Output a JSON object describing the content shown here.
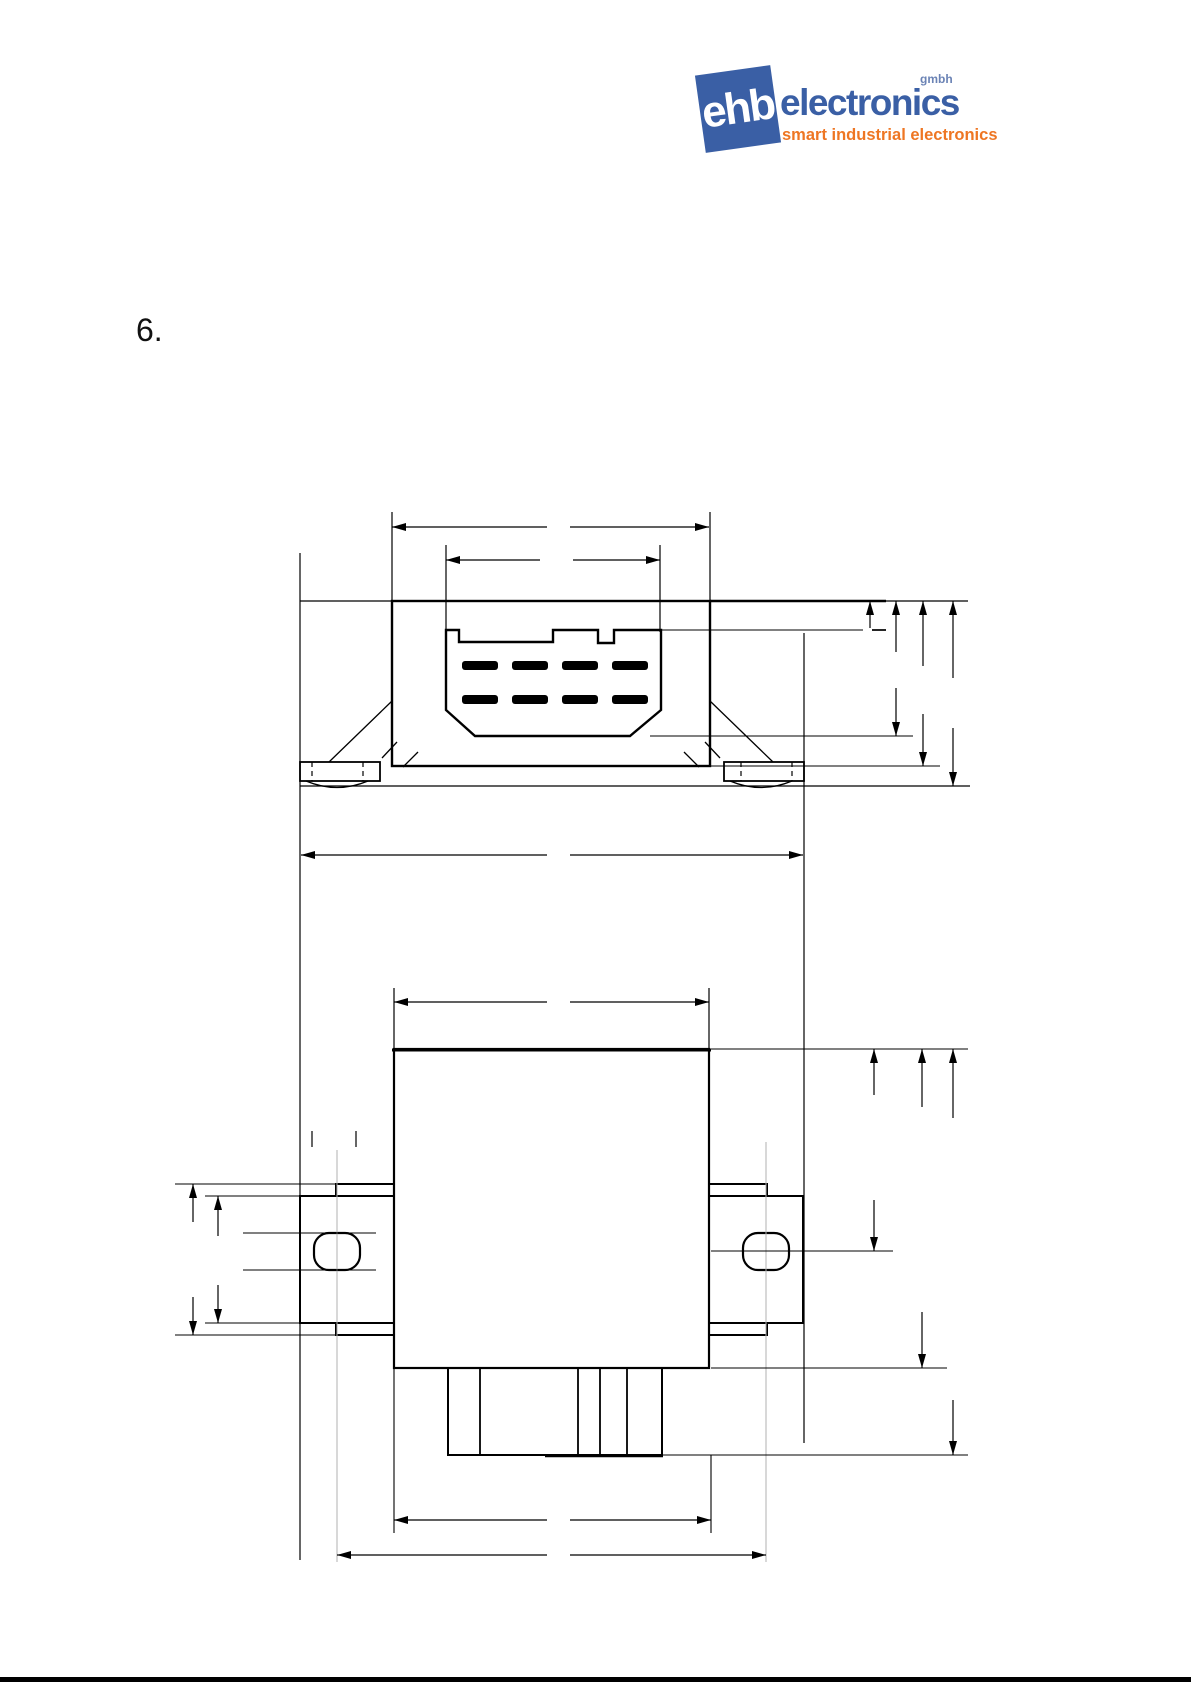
{
  "header": {
    "logo": {
      "box_text": "ehb",
      "wordmark": "electronics",
      "superscript": "gmbh",
      "tagline": "smart industrial electronics",
      "brand_blue": "#3a5fa5",
      "brand_orange": "#ee7623"
    }
  },
  "section": {
    "number": "6."
  },
  "drawing": {
    "type": "technical-dimension-drawing",
    "line_color": "#000000",
    "centerline_color": "#b0b0b0",
    "views": [
      {
        "name": "front-view",
        "content": "module front with 8-pin connector and two snap-in mounting feet"
      },
      {
        "name": "plan-view",
        "content": "module top view with two mounting tabs, slotted holes and bottom connector"
      }
    ],
    "connector": {
      "pin_rows": 2,
      "pins_per_row": 4
    },
    "dimension_labels_visible": false
  },
  "footer": {
    "bar_color": "#000000"
  }
}
